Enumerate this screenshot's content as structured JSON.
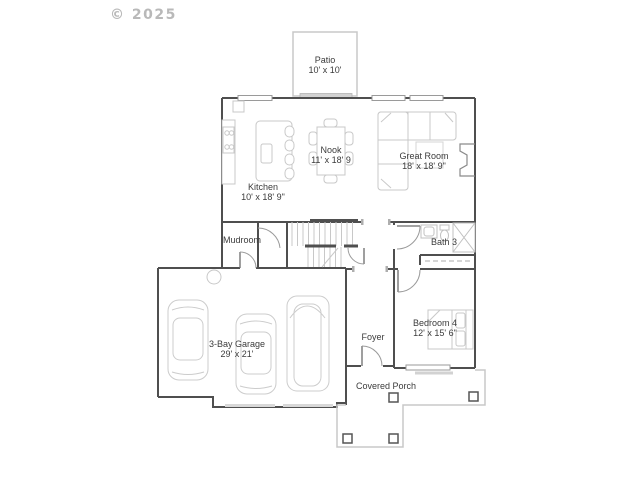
{
  "copyright": "© 2025",
  "colors": {
    "wall": "#4f4f4f",
    "furniture": "#c8c8c8",
    "label_text": "#3b3b3b",
    "watermark": "#b9b9b9",
    "background": "#ffffff"
  },
  "rooms": {
    "patio": {
      "name": "Patio",
      "dims": "10' x 10'"
    },
    "nook": {
      "name": "Nook",
      "dims": "11' x 18' 9"
    },
    "great_room": {
      "name": "Great Room",
      "dims": "18' x 18' 9\""
    },
    "kitchen": {
      "name": "Kitchen",
      "dims": "10' x 18' 9\""
    },
    "mudroom": {
      "name": "Mudroom",
      "dims": ""
    },
    "bath3": {
      "name": "Bath 3",
      "dims": ""
    },
    "bedroom4": {
      "name": "Bedroom 4",
      "dims": "12' x 15' 6\""
    },
    "garage": {
      "name": "3-Bay Garage",
      "dims": "29' x 21'"
    },
    "foyer": {
      "name": "Foyer",
      "dims": ""
    },
    "covered_porch": {
      "name": "Covered Porch",
      "dims": ""
    }
  }
}
